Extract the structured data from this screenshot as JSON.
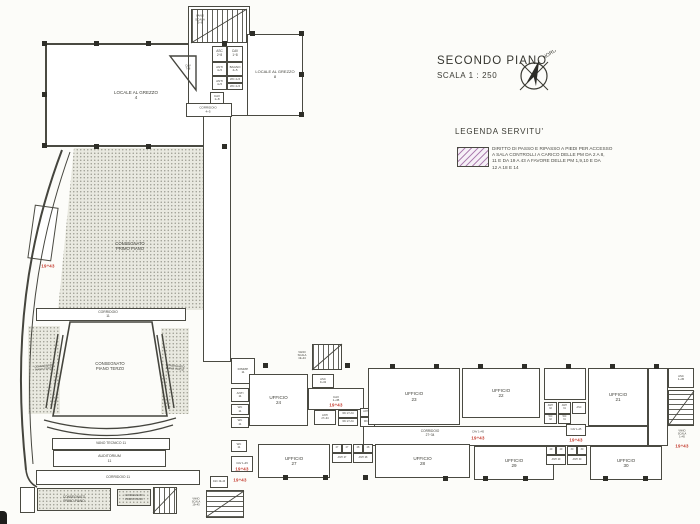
{
  "header": {
    "title": "SECONDO PIANO",
    "scale": "SCALA 1 : 250",
    "compass_label": "NORD"
  },
  "legend": {
    "heading": "LEGENDA SERVITU'",
    "lines": [
      "DIRITTO DI PASSO E RIPASSO A PIEDI PER ACCESSO",
      "A SALA CONTROLLI A CARICO DELLE PM DA 2 A 8,",
      "11 E DA 19 A 43 A FAVORE DELLE PM 1,9,10 E DA",
      "12 A 18 E 14"
    ]
  },
  "colors": {
    "ink": "#45453e",
    "red": "#c2372a",
    "paper": "#fcfcf9",
    "hatch": "#9c64a0"
  },
  "plan": {
    "rooms": [
      {
        "n": "locale-al-grezzo-4",
        "x": 45,
        "y": 43,
        "w": 182,
        "h": 104,
        "t": "",
        "bw": 2,
        "fs": 4.5,
        "label": [
          "LOCALE AL GREZZO",
          "4"
        ]
      },
      {
        "n": "stair-tower-top",
        "x": 188,
        "y": 6,
        "w": 62,
        "h": 110,
        "t": "",
        "bw": 1.6,
        "label": []
      },
      {
        "n": "stair-top-flight",
        "x": 191,
        "y": 9,
        "w": 56,
        "h": 34,
        "t": "stairs-v",
        "label": []
      },
      {
        "n": "asc-2-8",
        "x": 212,
        "y": 46,
        "w": 15,
        "h": 16,
        "t": "",
        "fs": 3.2,
        "label": [
          "ASC",
          "2÷8"
        ]
      },
      {
        "n": "cav-1-8",
        "x": 227,
        "y": 46,
        "w": 16,
        "h": 16,
        "t": "",
        "fs": 3.2,
        "label": [
          "CAV",
          "1÷8"
        ]
      },
      {
        "n": "anti-4-5-a",
        "x": 212,
        "y": 62,
        "w": 15,
        "h": 14,
        "t": "",
        "fs": 3,
        "label": [
          "ANTI",
          "4÷5"
        ]
      },
      {
        "n": "bagno-4-5",
        "x": 227,
        "y": 62,
        "w": 16,
        "h": 14,
        "t": "",
        "fs": 3,
        "label": [
          "BAGNO",
          "4÷5"
        ]
      },
      {
        "n": "anti-4-5-b",
        "x": 212,
        "y": 76,
        "w": 15,
        "h": 14,
        "t": "",
        "fs": 3,
        "label": [
          "ANTI",
          "4÷5"
        ]
      },
      {
        "n": "wc-4-5-a",
        "x": 227,
        "y": 76,
        "w": 16,
        "h": 7,
        "t": "",
        "fs": 2.8,
        "label": [
          "WC 4÷5"
        ]
      },
      {
        "n": "wc-4-5-b",
        "x": 227,
        "y": 83,
        "w": 16,
        "h": 7,
        "t": "",
        "fs": 2.8,
        "label": [
          "WC 4÷5"
        ]
      },
      {
        "n": "cav-1-8-b",
        "x": 210,
        "y": 92,
        "w": 14,
        "h": 12,
        "t": "",
        "fs": 3,
        "label": [
          "CAV",
          "1÷8"
        ]
      },
      {
        "n": "locale-al-grezzo-8",
        "x": 247,
        "y": 34,
        "w": 56,
        "h": 82,
        "t": "",
        "bw": 1.6,
        "fs": 4,
        "label": [
          "LOCALE AL GREZZO",
          "8"
        ]
      },
      {
        "n": "corridoio-4-5",
        "x": 186,
        "y": 103,
        "w": 46,
        "h": 14,
        "t": "",
        "label": []
      },
      {
        "n": "corridoio-vertical",
        "x": 203,
        "y": 116,
        "w": 28,
        "h": 246,
        "t": "",
        "bw": 1.4,
        "label": []
      },
      {
        "n": "consegnato-main-area",
        "x": 58,
        "y": 148,
        "w": 145,
        "h": 162,
        "t": "stipple clip-main",
        "label": []
      },
      {
        "n": "corridoio-11-top",
        "x": 36,
        "y": 308,
        "w": 150,
        "h": 13,
        "t": "",
        "label": []
      },
      {
        "n": "wedge-left",
        "x": 28,
        "y": 326,
        "w": 32,
        "h": 88,
        "t": "stipple",
        "label": []
      },
      {
        "n": "wedge-right",
        "x": 161,
        "y": 328,
        "w": 28,
        "h": 86,
        "t": "stipple",
        "label": []
      },
      {
        "n": "curve-room-left",
        "x": 31,
        "y": 206,
        "w": 24,
        "h": 54,
        "t": "",
        "rot": 8,
        "label": []
      },
      {
        "n": "vano-tecnico",
        "x": 52,
        "y": 438,
        "w": 118,
        "h": 12,
        "t": "",
        "bw": 1.8,
        "fs": 3.4,
        "label": [
          "VANO TECNICO 11"
        ]
      },
      {
        "n": "auditorium",
        "x": 53,
        "y": 450,
        "w": 113,
        "h": 17,
        "t": "",
        "fs": 3.6,
        "label": [
          "AUDITORIUM",
          "11"
        ]
      },
      {
        "n": "corridoio-11-bottom",
        "x": 36,
        "y": 470,
        "w": 164,
        "h": 15,
        "t": "",
        "fs": 3.4,
        "label": [
          "CORRIDOIO  11"
        ]
      },
      {
        "n": "consegnato-box-1",
        "x": 37,
        "y": 488,
        "w": 74,
        "h": 23,
        "t": "stipple-border",
        "fs": 3.2,
        "label": [
          "CONSEGNATO",
          "PRIMO PIANO"
        ]
      },
      {
        "n": "consegnato-box-2",
        "x": 117,
        "y": 489,
        "w": 34,
        "h": 17,
        "t": "stipple-border",
        "fs": 2.7,
        "label": [
          "CONSEGNATO",
          "PRIMO PIANO"
        ]
      },
      {
        "n": "stair-bottom-left-1",
        "x": 153,
        "y": 487,
        "w": 24,
        "h": 27,
        "t": "stairs-v",
        "label": []
      },
      {
        "n": "rooms-far-left-bottom",
        "x": 20,
        "y": 487,
        "w": 15,
        "h": 26,
        "t": "",
        "label": []
      },
      {
        "n": "disimp-11",
        "x": 231,
        "y": 358,
        "w": 24,
        "h": 26,
        "t": "",
        "fs": 3,
        "label": [
          "DISIMP.",
          "11"
        ]
      },
      {
        "n": "anti-11",
        "x": 231,
        "y": 388,
        "w": 18,
        "h": 14,
        "t": "",
        "fs": 3,
        "label": [
          "ANTI",
          "11"
        ]
      },
      {
        "n": "wc-11-a",
        "x": 231,
        "y": 404,
        "w": 18,
        "h": 11,
        "t": "",
        "fs": 2.8,
        "label": [
          "WC",
          "11"
        ]
      },
      {
        "n": "wc-11-b",
        "x": 231,
        "y": 417,
        "w": 18,
        "h": 11,
        "t": "",
        "fs": 2.8,
        "label": [
          "WC",
          "11"
        ]
      },
      {
        "n": "ufficio-24",
        "x": 249,
        "y": 374,
        "w": 59,
        "h": 52,
        "t": "",
        "bw": 1.5,
        "fs": 4.6,
        "label": [
          "UFFICIO",
          "24"
        ]
      },
      {
        "n": "stair-mid-top",
        "x": 312,
        "y": 344,
        "w": 30,
        "h": 26,
        "t": "stairs-v",
        "label": []
      },
      {
        "n": "asc-9-43",
        "x": 312,
        "y": 374,
        "w": 22,
        "h": 14,
        "t": "",
        "fs": 2.8,
        "label": [
          "ASC",
          "9÷43"
        ]
      },
      {
        "n": "cav-1-45-a",
        "x": 308,
        "y": 388,
        "w": 56,
        "h": 22,
        "t": "",
        "fs": 3,
        "label": [
          "CAV",
          "1÷45"
        ]
      },
      {
        "n": "anti-27-34",
        "x": 314,
        "y": 410,
        "w": 22,
        "h": 15,
        "t": "",
        "fs": 2.6,
        "label": [
          "ANTI",
          "27÷34"
        ]
      },
      {
        "n": "wc-27-34-a",
        "x": 338,
        "y": 410,
        "w": 20,
        "h": 8,
        "t": "",
        "fs": 2.4,
        "label": [
          "WC 27÷34"
        ]
      },
      {
        "n": "wc-27-34-b",
        "x": 338,
        "y": 418,
        "w": 20,
        "h": 8,
        "t": "",
        "fs": 2.4,
        "label": [
          "WC 27÷34"
        ]
      },
      {
        "n": "anti-33",
        "x": 360,
        "y": 408,
        "w": 15,
        "h": 9,
        "t": "",
        "fs": 2.4,
        "label": [
          "ANTI 33"
        ]
      },
      {
        "n": "wc-33",
        "x": 360,
        "y": 417,
        "w": 15,
        "h": 10,
        "t": "",
        "fs": 2.4,
        "label": [
          "WC 33"
        ]
      },
      {
        "n": "ufficio-23",
        "x": 368,
        "y": 368,
        "w": 92,
        "h": 57,
        "t": "",
        "bw": 1.5,
        "fs": 4.6,
        "label": [
          "UFFICIO",
          "23"
        ]
      },
      {
        "n": "ufficio-22",
        "x": 462,
        "y": 368,
        "w": 78,
        "h": 50,
        "t": "",
        "bw": 1.5,
        "fs": 4.6,
        "label": [
          "UFFICIO",
          "22"
        ]
      },
      {
        "n": "corridoio-27-34",
        "x": 363,
        "y": 426,
        "w": 285,
        "h": 20,
        "t": "",
        "bw": 1.4,
        "label": []
      },
      {
        "n": "vano-above-cluster",
        "x": 544,
        "y": 368,
        "w": 42,
        "h": 32,
        "t": "",
        "label": []
      },
      {
        "n": "anti-32",
        "x": 544,
        "y": 402,
        "w": 13,
        "h": 12,
        "t": "",
        "fs": 2.4,
        "label": [
          "ANTI",
          "32"
        ]
      },
      {
        "n": "wc-32",
        "x": 544,
        "y": 414,
        "w": 13,
        "h": 10,
        "t": "",
        "fs": 2.4,
        "label": [
          "WC",
          "32"
        ]
      },
      {
        "n": "anti-31",
        "x": 558,
        "y": 402,
        "w": 13,
        "h": 12,
        "t": "",
        "fs": 2.4,
        "label": [
          "ANTI",
          "31"
        ]
      },
      {
        "n": "wc-31",
        "x": 558,
        "y": 414,
        "w": 13,
        "h": 10,
        "t": "",
        "fs": 2.4,
        "label": [
          "WC",
          "31"
        ]
      },
      {
        "n": "asc-mid",
        "x": 572,
        "y": 402,
        "w": 14,
        "h": 12,
        "t": "",
        "fs": 2.4,
        "label": [
          "ASC"
        ]
      },
      {
        "n": "cav-1-45-mid",
        "x": 566,
        "y": 424,
        "w": 20,
        "h": 12,
        "t": "",
        "fs": 2.4,
        "label": [
          "CAV 1÷45"
        ]
      },
      {
        "n": "ufficio-21",
        "x": 588,
        "y": 368,
        "w": 60,
        "h": 58,
        "t": "",
        "bw": 1.5,
        "fs": 4.6,
        "label": [
          "UFFICIO",
          "21"
        ]
      },
      {
        "n": "corridor-right-end",
        "x": 648,
        "y": 368,
        "w": 20,
        "h": 78,
        "t": "",
        "label": []
      },
      {
        "n": "asc-right",
        "x": 668,
        "y": 368,
        "w": 26,
        "h": 20,
        "t": "",
        "fs": 2.8,
        "label": [
          "ASC",
          "1÷45"
        ]
      },
      {
        "n": "stair-right",
        "x": 668,
        "y": 390,
        "w": 26,
        "h": 36,
        "t": "stairs-h",
        "label": []
      },
      {
        "n": "ufficio-27",
        "x": 258,
        "y": 444,
        "w": 72,
        "h": 34,
        "t": "",
        "bw": 1.5,
        "fs": 4.6,
        "label": [
          "UFFICIO",
          "27"
        ]
      },
      {
        "n": "wc-27-c1",
        "x": 332,
        "y": 444,
        "w": 10,
        "h": 9,
        "t": "",
        "fs": 2.4,
        "label": [
          "27"
        ]
      },
      {
        "n": "wc-27-c2",
        "x": 342,
        "y": 444,
        "w": 10,
        "h": 9,
        "t": "",
        "fs": 2.4,
        "label": [
          "27"
        ]
      },
      {
        "n": "wc-28-c1",
        "x": 353,
        "y": 444,
        "w": 10,
        "h": 9,
        "t": "",
        "fs": 2.4,
        "label": [
          "28"
        ]
      },
      {
        "n": "wc-28-c2",
        "x": 363,
        "y": 444,
        "w": 10,
        "h": 9,
        "t": "",
        "fs": 2.4,
        "label": [
          "28"
        ]
      },
      {
        "n": "anti-27-b",
        "x": 332,
        "y": 453,
        "w": 20,
        "h": 10,
        "t": "",
        "fs": 2.4,
        "label": [
          "ANTI 27"
        ]
      },
      {
        "n": "anti-28-b",
        "x": 353,
        "y": 453,
        "w": 20,
        "h": 10,
        "t": "",
        "fs": 2.4,
        "label": [
          "ANTI 28"
        ]
      },
      {
        "n": "ufficio-28",
        "x": 375,
        "y": 444,
        "w": 95,
        "h": 34,
        "t": "",
        "bw": 1.5,
        "fs": 4.6,
        "label": [
          "UFFICIO",
          "28"
        ]
      },
      {
        "n": "ufficio-29",
        "x": 474,
        "y": 446,
        "w": 80,
        "h": 34,
        "t": "",
        "bw": 1.5,
        "fs": 4.6,
        "label": [
          "UFFICIO",
          "29"
        ]
      },
      {
        "n": "wc-29-c1",
        "x": 546,
        "y": 446,
        "w": 10,
        "h": 9,
        "t": "",
        "fs": 2.4,
        "label": [
          "29"
        ]
      },
      {
        "n": "wc-29-c2",
        "x": 556,
        "y": 446,
        "w": 10,
        "h": 9,
        "t": "",
        "fs": 2.4,
        "label": [
          "29"
        ]
      },
      {
        "n": "wc-30-c1",
        "x": 567,
        "y": 446,
        "w": 10,
        "h": 9,
        "t": "",
        "fs": 2.4,
        "label": [
          "30"
        ]
      },
      {
        "n": "wc-30-c2",
        "x": 577,
        "y": 446,
        "w": 10,
        "h": 9,
        "t": "",
        "fs": 2.4,
        "label": [
          "30"
        ]
      },
      {
        "n": "anti-29-b",
        "x": 546,
        "y": 455,
        "w": 20,
        "h": 10,
        "t": "",
        "fs": 2.4,
        "label": [
          "ANTI 29"
        ]
      },
      {
        "n": "anti-30-b",
        "x": 567,
        "y": 455,
        "w": 20,
        "h": 10,
        "t": "",
        "fs": 2.4,
        "label": [
          "ANTI 30"
        ]
      },
      {
        "n": "ufficio-30",
        "x": 590,
        "y": 446,
        "w": 72,
        "h": 34,
        "t": "",
        "bw": 1.5,
        "fs": 4.6,
        "label": [
          "UFFICIO",
          "30"
        ]
      },
      {
        "n": "wc-11-c",
        "x": 231,
        "y": 440,
        "w": 16,
        "h": 12,
        "t": "",
        "fs": 2.8,
        "label": [
          "WC",
          "11"
        ]
      },
      {
        "n": "cav-1-45-bl",
        "x": 231,
        "y": 456,
        "w": 22,
        "h": 16,
        "t": "",
        "fs": 2.6,
        "label": [
          "CAV 1÷45"
        ]
      },
      {
        "n": "asc-19-43",
        "x": 210,
        "y": 476,
        "w": 18,
        "h": 12,
        "t": "",
        "fs": 2.4,
        "label": [
          "ASC 19÷43"
        ]
      },
      {
        "n": "stair-bottom-left-2",
        "x": 206,
        "y": 490,
        "w": 38,
        "h": 28,
        "t": "stairs-h",
        "label": []
      }
    ],
    "labels": [
      {
        "lines": [
          "VANO",
          "SCALA",
          "2÷8"
        ],
        "x": 200,
        "y": 20,
        "fs": 3
      },
      {
        "lines": [
          "CORRIDOIO",
          "4÷5"
        ],
        "x": 208,
        "y": 110,
        "fs": 3
      },
      {
        "lines": [
          "CAV",
          "7÷8"
        ],
        "x": 188,
        "y": 68,
        "fs": 2.8
      },
      {
        "lines": [
          "CONSEGNATO",
          "PRIMO PIANO"
        ],
        "x": 130,
        "y": 246,
        "fs": 4.2
      },
      {
        "lines": [
          "CORRIDOIO",
          "11"
        ],
        "x": 108,
        "y": 314,
        "fs": 3.4
      },
      {
        "lines": [
          "CONSEGNATO",
          "PIANO TERZO"
        ],
        "x": 110,
        "y": 366,
        "fs": 4.2
      },
      {
        "lines": [
          "CONSEGNATO",
          "PIANO TERZO"
        ],
        "x": 44,
        "y": 368,
        "fs": 2.7,
        "rot": -6
      },
      {
        "lines": [
          "CONSEGNATO",
          "PIANO TERZO"
        ],
        "x": 175,
        "y": 368,
        "fs": 2.7,
        "rot": 6
      },
      {
        "lines": [
          "VANO",
          "SCALA",
          "19÷43"
        ],
        "x": 302,
        "y": 356,
        "fs": 2.7
      },
      {
        "lines": [
          "CORRIDOIO",
          "27÷34"
        ],
        "x": 430,
        "y": 434,
        "fs": 3.2
      },
      {
        "lines": [
          "CAV 1÷45"
        ],
        "x": 478,
        "y": 432,
        "fs": 2.7
      },
      {
        "lines": [
          "VANO",
          "SCALA",
          "1÷45"
        ],
        "x": 682,
        "y": 434,
        "fs": 2.6
      },
      {
        "lines": [
          "VANO",
          "SCALA",
          "19÷43"
        ],
        "x": 196,
        "y": 502,
        "fs": 2.6
      }
    ],
    "red_marks": [
      {
        "text": "19÷43",
        "x": 48,
        "y": 266
      },
      {
        "text": "19÷43",
        "x": 336,
        "y": 405
      },
      {
        "text": "19÷43",
        "x": 478,
        "y": 438
      },
      {
        "text": "19÷43",
        "x": 576,
        "y": 440
      },
      {
        "text": "19÷43",
        "x": 682,
        "y": 446
      },
      {
        "text": "19÷43",
        "x": 242,
        "y": 469
      },
      {
        "text": "19÷43",
        "x": 240,
        "y": 480
      }
    ],
    "columns": [
      [
        42,
        41
      ],
      [
        94,
        41
      ],
      [
        146,
        41
      ],
      [
        222,
        41
      ],
      [
        42,
        92
      ],
      [
        42,
        143
      ],
      [
        94,
        144
      ],
      [
        146,
        144
      ],
      [
        222,
        144
      ],
      [
        250,
        31
      ],
      [
        299,
        31
      ],
      [
        299,
        72
      ],
      [
        299,
        112
      ],
      [
        263,
        363
      ],
      [
        345,
        363
      ],
      [
        390,
        364
      ],
      [
        434,
        364
      ],
      [
        478,
        364
      ],
      [
        522,
        364
      ],
      [
        566,
        364
      ],
      [
        610,
        364
      ],
      [
        654,
        364
      ],
      [
        283,
        475
      ],
      [
        323,
        475
      ],
      [
        363,
        475
      ],
      [
        443,
        476
      ],
      [
        483,
        476
      ],
      [
        523,
        476
      ],
      [
        603,
        476
      ],
      [
        643,
        476
      ]
    ]
  }
}
